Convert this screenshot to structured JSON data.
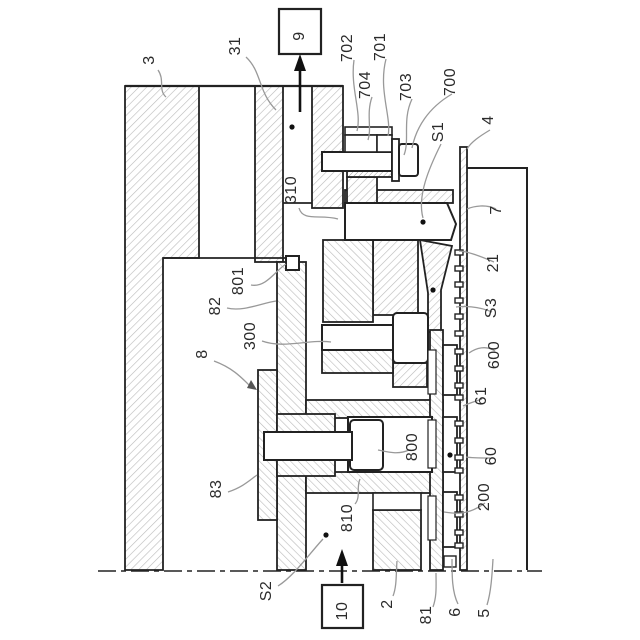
{
  "figure": {
    "type": "patent-cross-section-drawing",
    "colors": {
      "line": "#222222",
      "hatch": "#b9b9b9",
      "leader": "#999999",
      "text": "#2b2b2b",
      "background": "#ffffff"
    },
    "labels": {
      "p3": "3",
      "p31": "31",
      "p9": "9",
      "p702": "702",
      "p701": "701",
      "p704": "704",
      "p703": "703",
      "p700": "700",
      "s1": "S1",
      "p4": "4",
      "p7": "7",
      "p310": "310",
      "p801": "801",
      "p82": "82",
      "p21": "21",
      "s3": "S3",
      "p300": "300",
      "p8": "8",
      "p600": "600",
      "p61": "61",
      "p800": "800",
      "p60": "60",
      "p83": "83",
      "p200": "200",
      "p810": "810",
      "s2": "S2",
      "p10": "10",
      "p2": "2",
      "p81": "81",
      "p6": "6",
      "p5": "5"
    }
  }
}
